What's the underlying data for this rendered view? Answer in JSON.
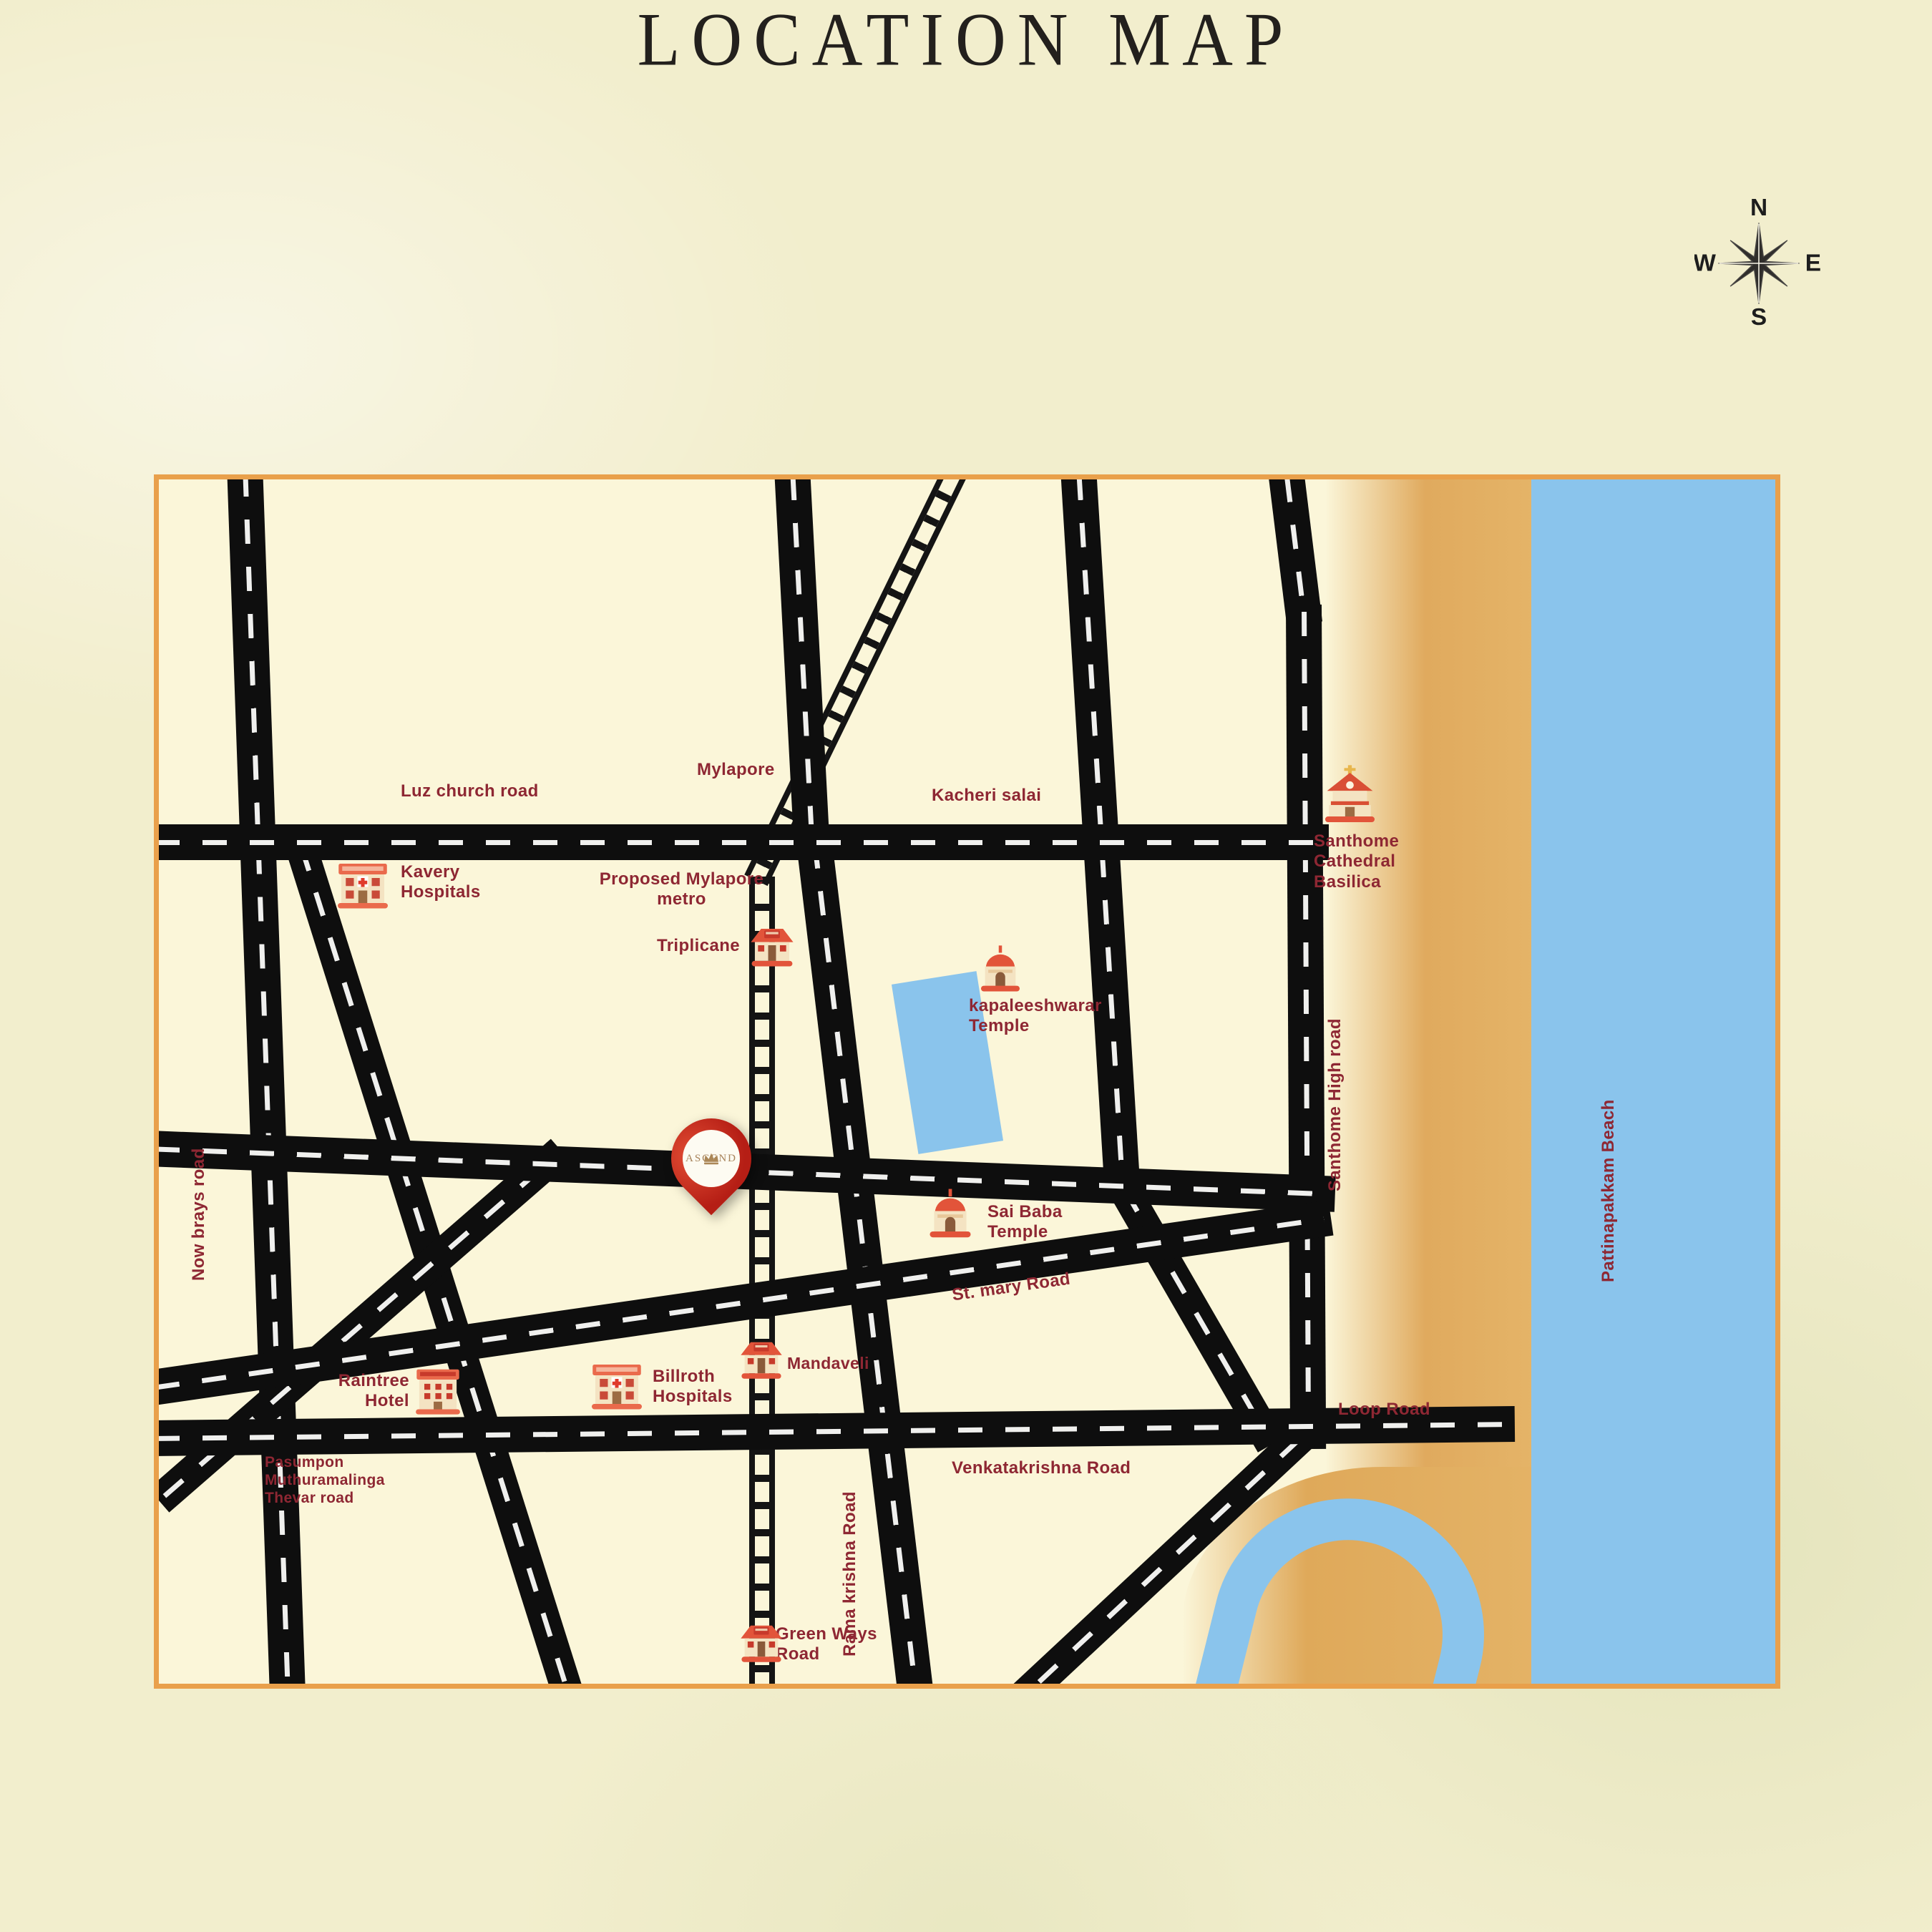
{
  "page": {
    "title": "LOCATION MAP"
  },
  "compass": {
    "north": "N",
    "east": "E",
    "south": "S",
    "west": "W"
  },
  "colors": {
    "background": "#f2eecd",
    "map_background": "#fbf6d9",
    "map_border": "#e9a04b",
    "road": "#0e0e0e",
    "road_dash": "#f0f0ee",
    "label": "#8e2733",
    "water": "#8ac4ec",
    "sand": "#e0aa5e",
    "pin_red": "#b51e15",
    "pin_logo_gold": "#a8845c"
  },
  "map": {
    "roads": {
      "luz_church": "Luz church road",
      "kacheri_salai": "Kacheri salai",
      "santhome_high": "Santhome High road",
      "st_mary": "St. mary Road",
      "loop": "Loop Road",
      "venkatakrishna": "Venkatakrishna Road",
      "pasumpon": "Pasumpon Muthuramalinga Thevar road",
      "rama_krishna": "Rama krishna Road",
      "now_brays": "Now brays road",
      "beach": "Pattinapakkam Beach"
    },
    "areas": {
      "mylapore": "Mylapore"
    },
    "stations": {
      "metro_note": "Proposed Mylapore metro",
      "triplicane": "Triplicane",
      "mandaveli": "Mandaveli",
      "green_ways": "Green Ways Road"
    },
    "landmarks": {
      "kavery": "Kavery Hospitals",
      "kapaleeshwarar": "kapaleeshwarar Temple",
      "santhome_cathedral": "Santhome Cathedral Basilica",
      "sai_baba": "Sai Baba Temple",
      "raintree": "Raintree Hotel",
      "billroth": "Billroth Hospitals"
    },
    "pin": {
      "brand": "ASCEND",
      "icon": "crown-icon"
    }
  }
}
